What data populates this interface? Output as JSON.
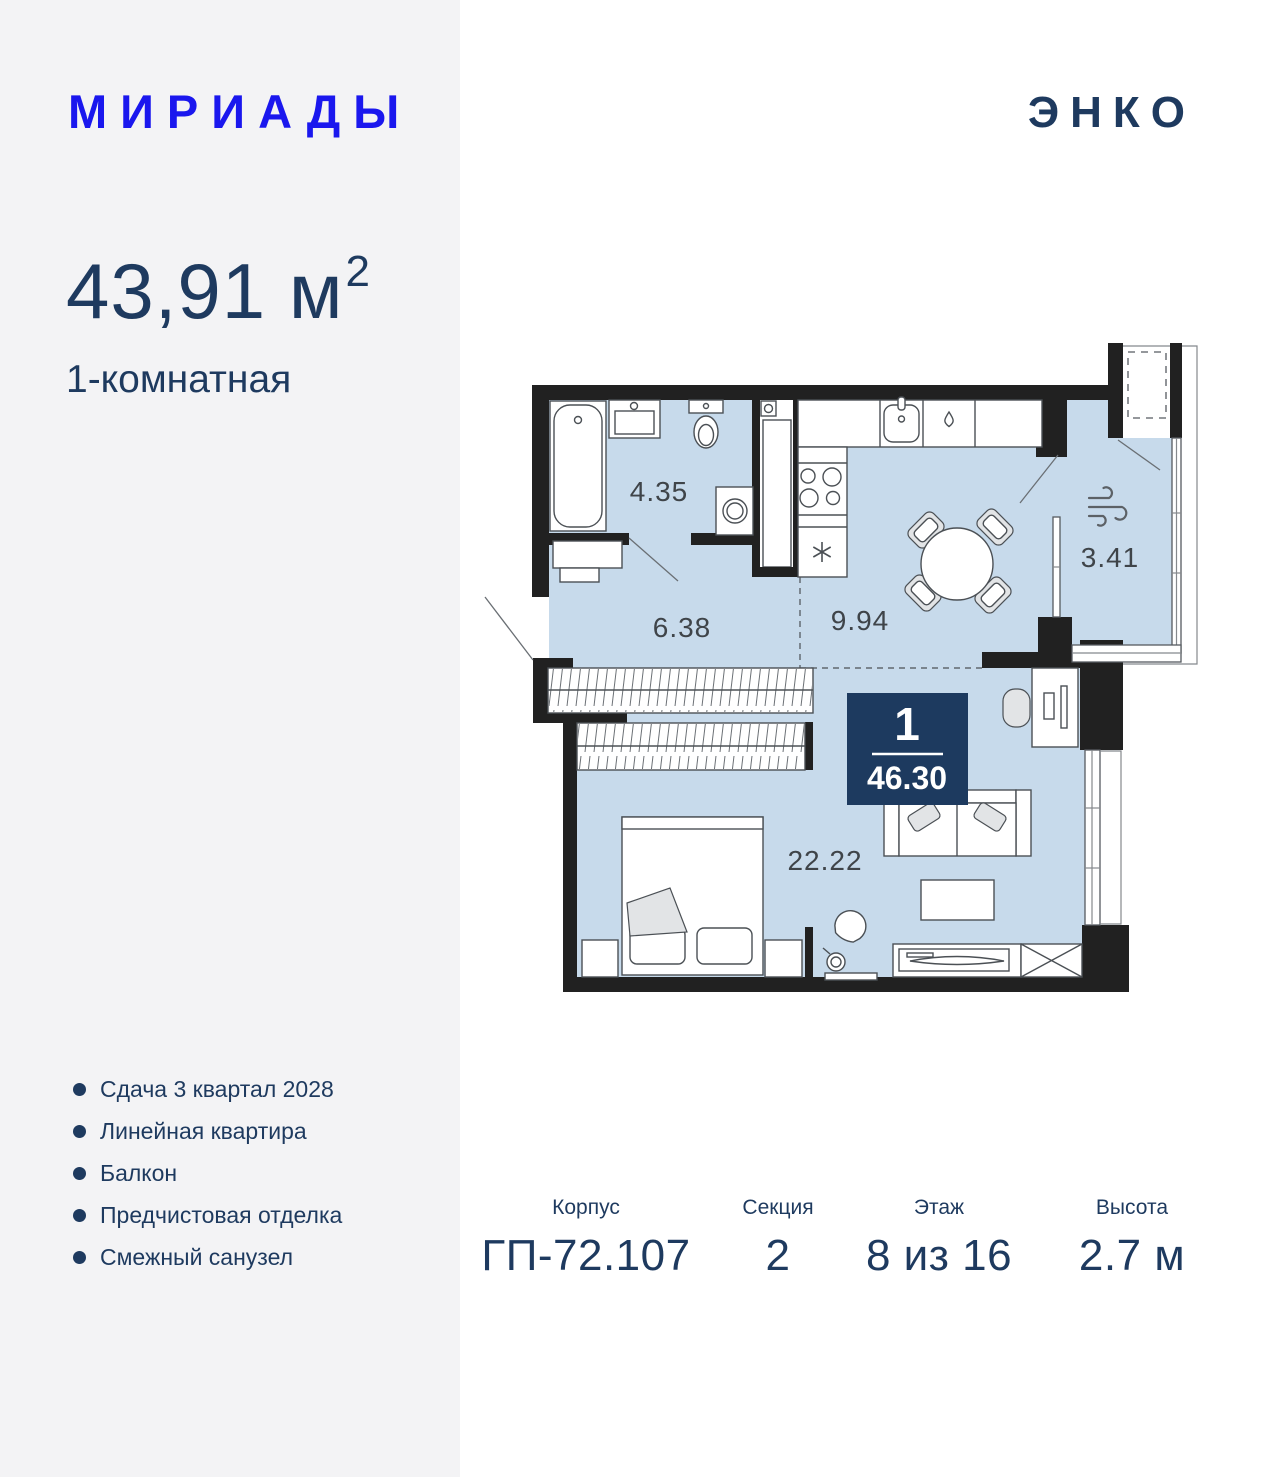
{
  "header": {
    "project_logo": "МИРИАДЫ",
    "developer_logo": "ЭНКО"
  },
  "listing": {
    "area_value": "43,91",
    "area_unit": "м",
    "area_superscript": "2",
    "rooms_type": "1-комнатная"
  },
  "features": {
    "items": [
      "Сдача 3 квартал 2028",
      "Линейная квартира",
      "Балкон",
      "Предчистовая отделка",
      "Смежный санузел"
    ]
  },
  "plan": {
    "room_labels": [
      {
        "name": "bathroom",
        "area": "4.35"
      },
      {
        "name": "hallway",
        "area": "6.38"
      },
      {
        "name": "kitchen",
        "area": "9.94"
      },
      {
        "name": "loggia",
        "area": "3.41"
      },
      {
        "name": "living-room",
        "area": "22.22"
      }
    ],
    "badge": {
      "rooms_count": "1",
      "total_area": "46.30"
    }
  },
  "details": {
    "columns": [
      {
        "label": "Корпус",
        "value": "ГП-72.107"
      },
      {
        "label": "Секция",
        "value": "2"
      },
      {
        "label": "Этаж",
        "value": "8 из 16"
      },
      {
        "label": "Высота",
        "value": "2.7 м"
      }
    ]
  },
  "colors": {
    "logo_blue": "#1a17ee",
    "navy": "#1e3a5f",
    "panel_bg": "#f3f3f5",
    "room_fill": "#c7daeb",
    "wall": "#212121",
    "badge_bg": "#1d3a5f"
  }
}
